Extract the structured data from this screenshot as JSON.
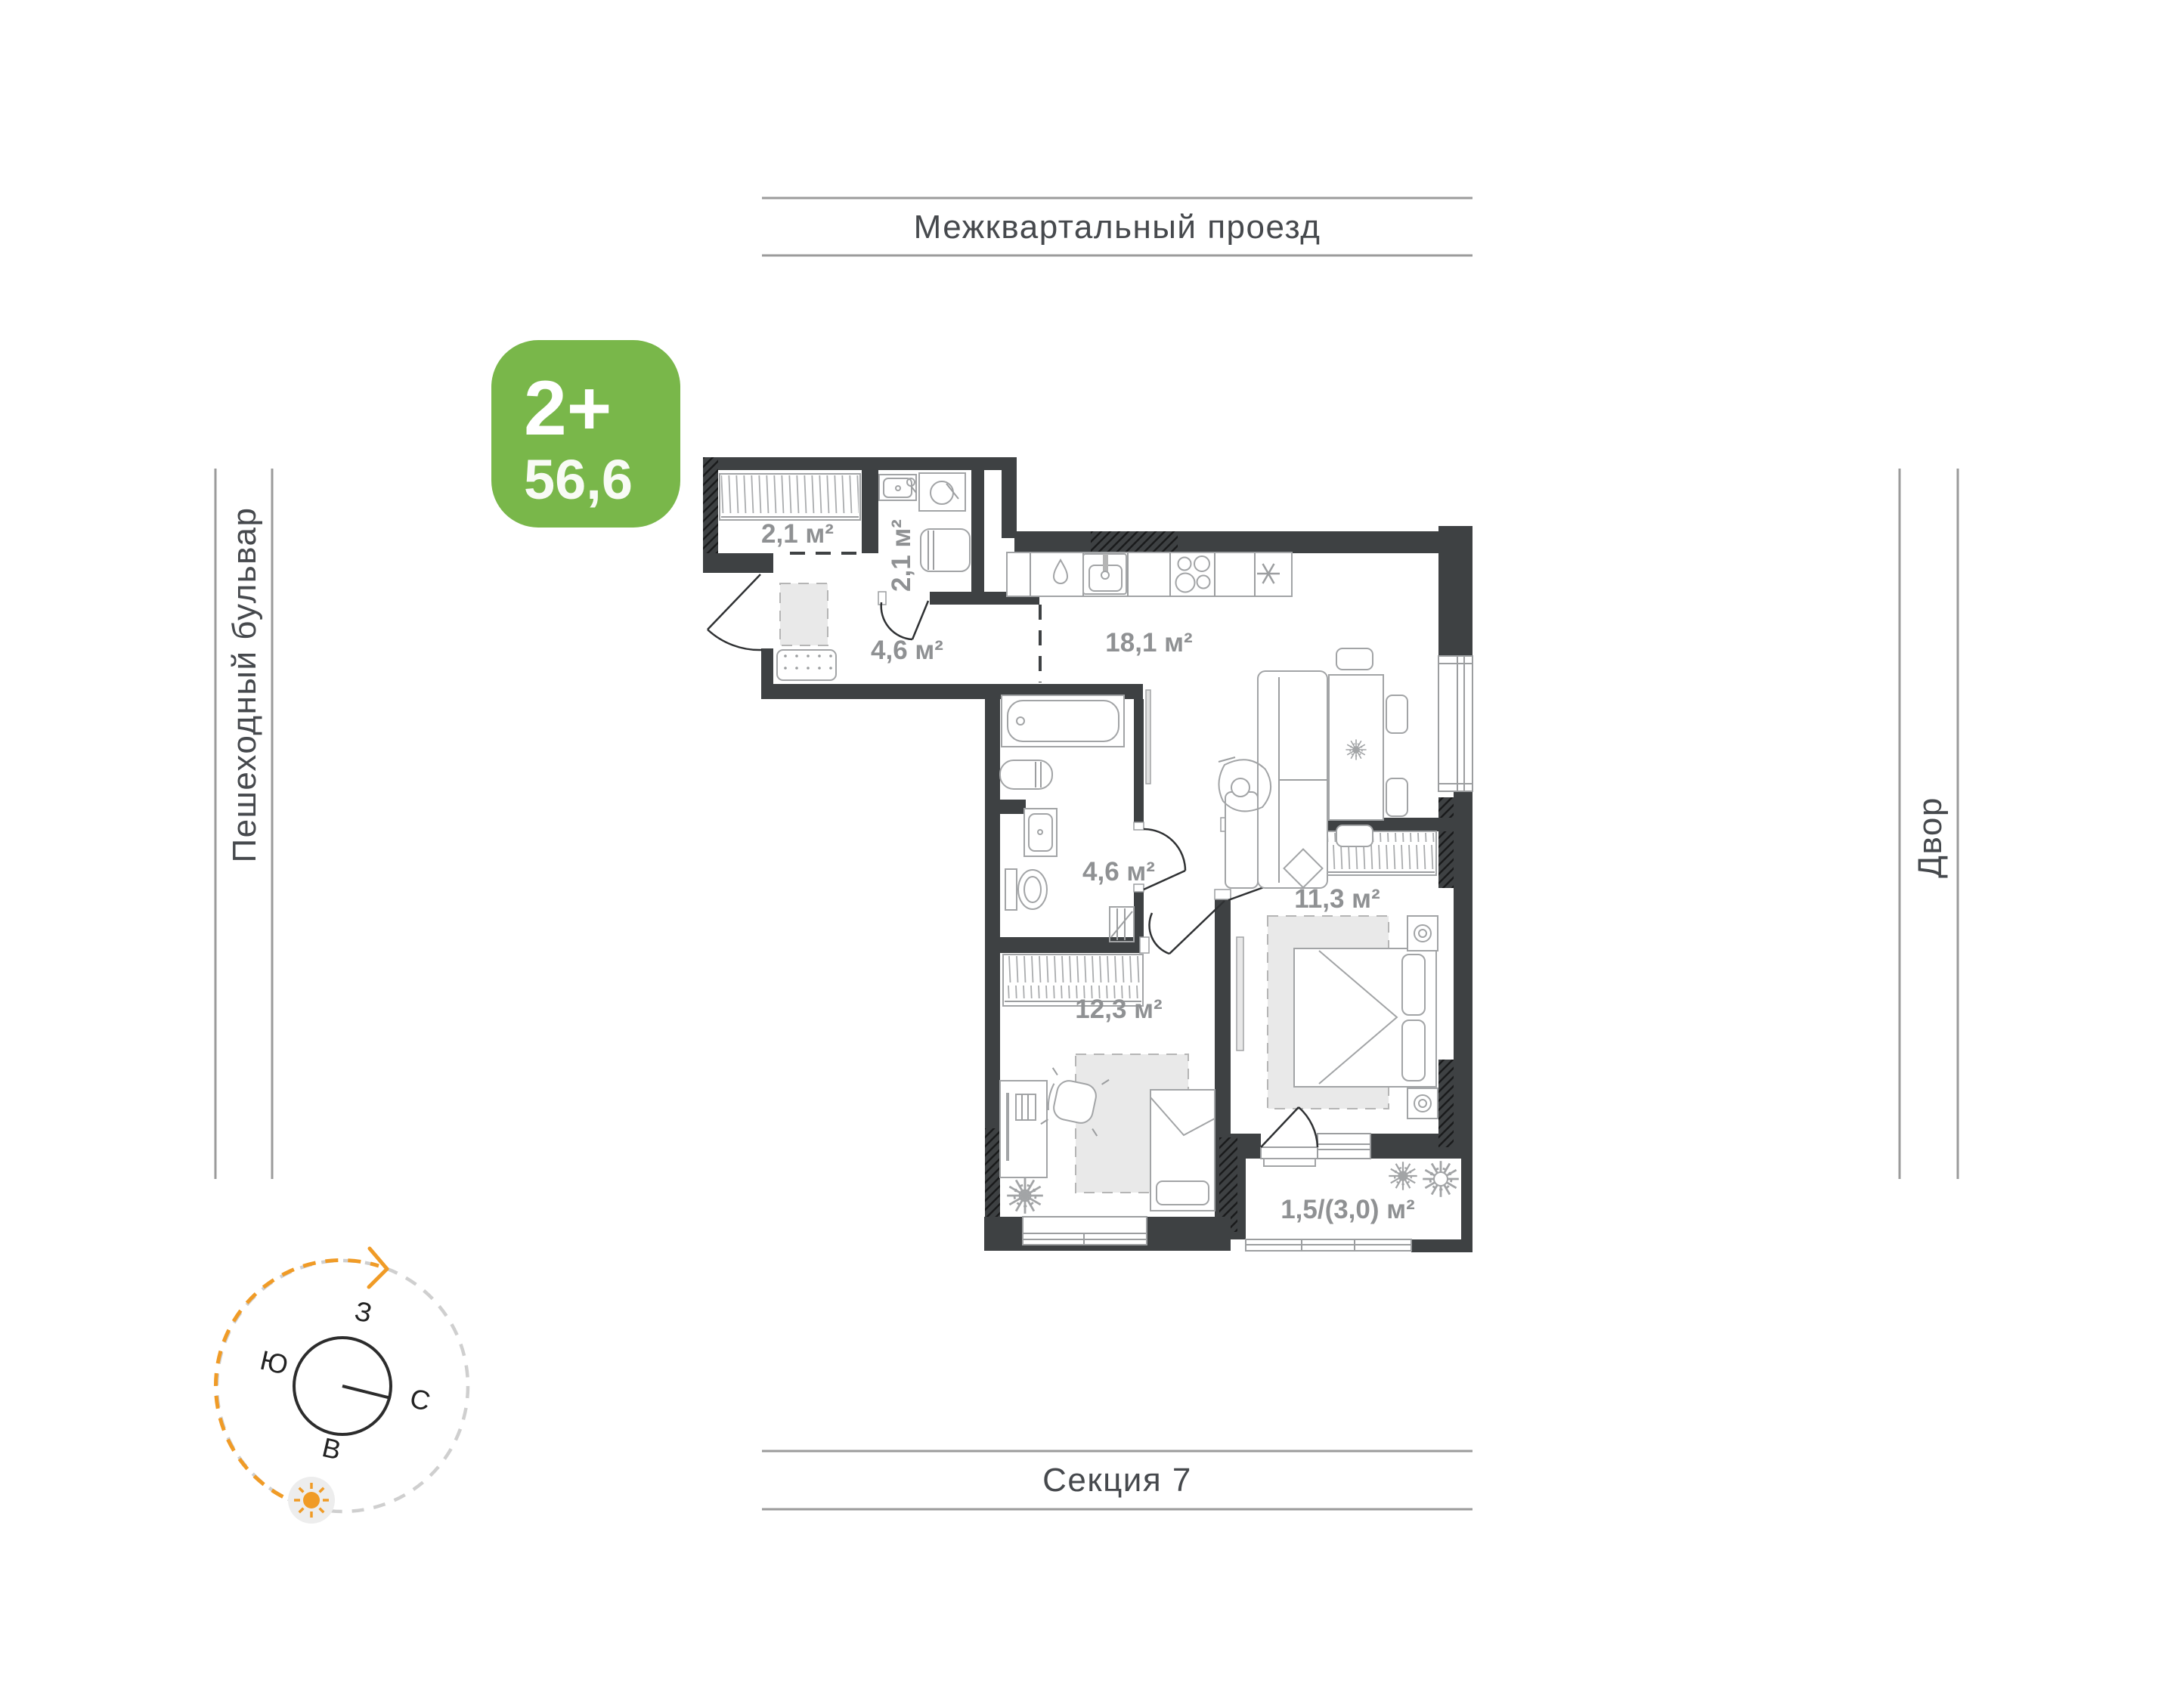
{
  "surroundings": {
    "top": "Межквартальный проезд",
    "bottom": "Секция 7",
    "left": "Пешеходный бульвар",
    "right": "Двор"
  },
  "badge": {
    "type_label": "2+",
    "area_value": "56,6",
    "color": "#79b74a"
  },
  "plan": {
    "rooms": [
      {
        "name": "wardrobe",
        "area_label": "2,1 м²"
      },
      {
        "name": "bathroom-small",
        "area_label": "2,1 м²"
      },
      {
        "name": "hallway",
        "area_label": "4,6 м²"
      },
      {
        "name": "kitchen-living",
        "area_label": "18,1 м²"
      },
      {
        "name": "bathroom",
        "area_label": "4,6 м²"
      },
      {
        "name": "bedroom",
        "area_label": "11,3 м²"
      },
      {
        "name": "room",
        "area_label": "12,3 м²"
      },
      {
        "name": "balcony",
        "area_label": "1,5/(3,0) м²"
      }
    ]
  },
  "compass": {
    "west": "З",
    "south": "Ю",
    "north": "С",
    "east": "В",
    "arc_color": "#f09b26"
  }
}
